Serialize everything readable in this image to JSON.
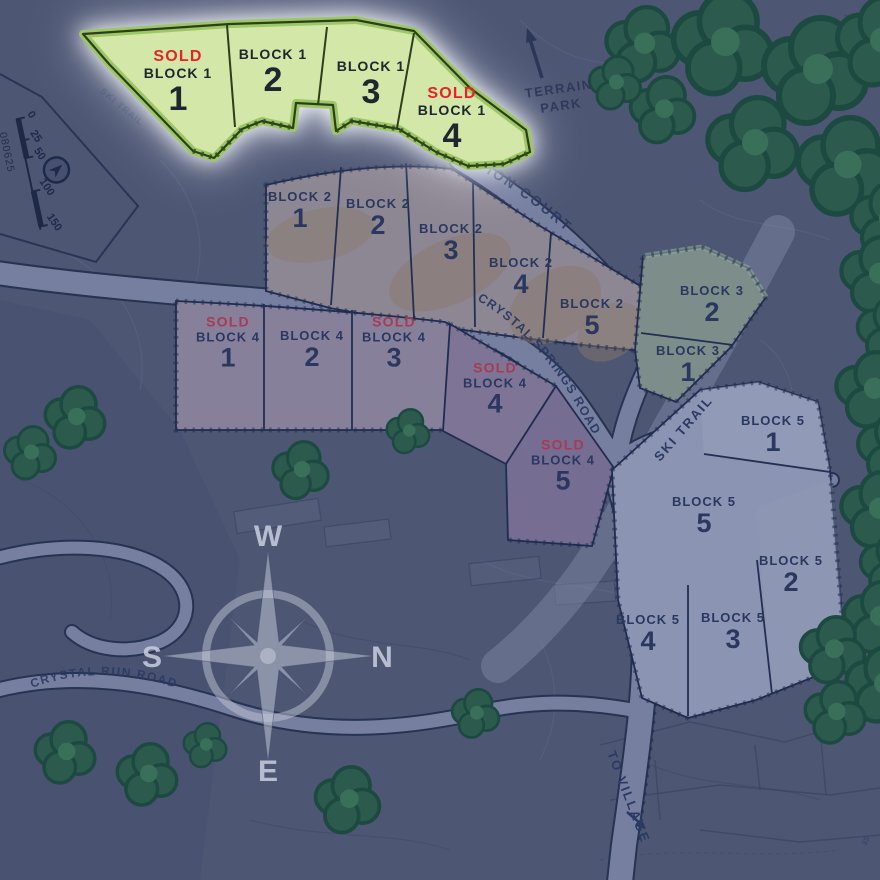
{
  "colors": {
    "background": "#4d5673",
    "block1_fill": "#d2e7a8",
    "block2_fill": "#8d8793",
    "block3_fill": "#7c8d8a",
    "block4_fill": "#87809b",
    "block5_fill": "#8b94b2",
    "sold_bright": "#e72329",
    "sold_muted": "#a83b53",
    "label_navy": "#2b3a63",
    "road": "#767f9f",
    "tree": "#2c5b4d"
  },
  "scale_bar": {
    "ticks": [
      "0",
      "25",
      "50",
      "100",
      "150"
    ],
    "code": "080625"
  },
  "compass": {
    "west": "W",
    "south": "S",
    "north": "N",
    "east": "E"
  },
  "labels": {
    "terrain_park": "TERRAIN PARK",
    "station_court": "STATION COURT",
    "crystal_springs_road": "CRYSTAL SPRINGS ROAD",
    "crystal_run_road": "CRYSTAL RUN ROAD",
    "ski_trail": "SKI TRAIL",
    "ski_trail_upper": "SKI TRAIL",
    "to_village": "TO VILLAGE",
    "contour_35": "35"
  },
  "blocks": [
    {
      "name": "Block 1",
      "lots": [
        {
          "block_label": "BLOCK 1",
          "number": "1",
          "sold_label": "SOLD"
        },
        {
          "block_label": "BLOCK 1",
          "number": "2"
        },
        {
          "block_label": "BLOCK 1",
          "number": "3"
        },
        {
          "block_label": "BLOCK 1",
          "number": "4",
          "sold_label": "SOLD"
        }
      ]
    },
    {
      "name": "Block 2",
      "lots": [
        {
          "block_label": "BLOCK 2",
          "number": "1"
        },
        {
          "block_label": "BLOCK 2",
          "number": "2"
        },
        {
          "block_label": "BLOCK 2",
          "number": "3"
        },
        {
          "block_label": "BLOCK 2",
          "number": "4"
        },
        {
          "block_label": "BLOCK 2",
          "number": "5"
        }
      ]
    },
    {
      "name": "Block 3",
      "lots": [
        {
          "block_label": "BLOCK 3",
          "number": "2"
        },
        {
          "block_label": "BLOCK 3",
          "number": "1"
        }
      ]
    },
    {
      "name": "Block 4",
      "lots": [
        {
          "block_label": "BLOCK 4",
          "number": "1",
          "sold_label": "SOLD"
        },
        {
          "block_label": "BLOCK 4",
          "number": "2"
        },
        {
          "block_label": "BLOCK 4",
          "number": "3",
          "sold_label": "SOLD"
        },
        {
          "block_label": "BLOCK 4",
          "number": "4",
          "sold_label": "SOLD"
        },
        {
          "block_label": "BLOCK 4",
          "number": "5",
          "sold_label": "SOLD"
        }
      ]
    },
    {
      "name": "Block 5",
      "lots": [
        {
          "block_label": "BLOCK 5",
          "number": "1"
        },
        {
          "block_label": "BLOCK 5",
          "number": "5"
        },
        {
          "block_label": "BLOCK 5",
          "number": "2"
        },
        {
          "block_label": "BLOCK 5",
          "number": "4"
        },
        {
          "block_label": "BLOCK 5",
          "number": "3"
        }
      ]
    }
  ]
}
